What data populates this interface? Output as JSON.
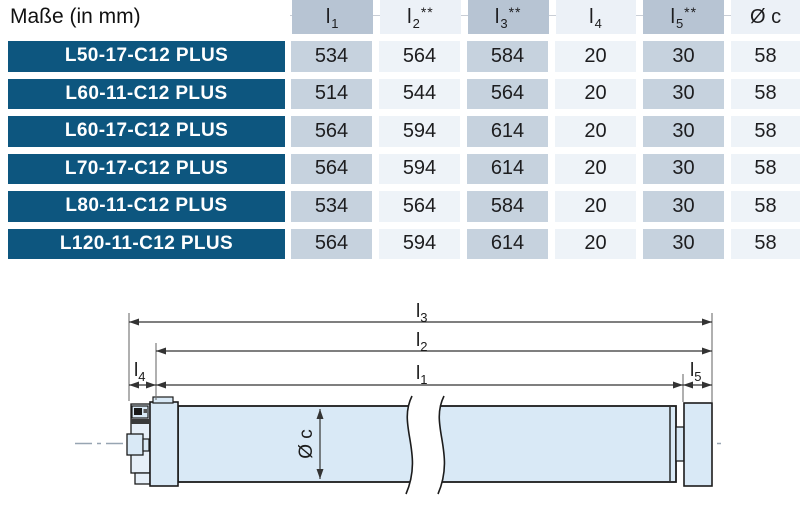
{
  "colors": {
    "model_badge_blue": "#0d567f",
    "header_col_dark": "#b7c4d3",
    "header_col_light": "#ecf1f7",
    "data_col_dark": "#c6d2de",
    "data_col_light": "#eef3f8",
    "tube_fill_blue": "#d9e9f6",
    "outline_dark": "#1c1c1c"
  },
  "table": {
    "title": "Maße (in mm)",
    "columns": [
      {
        "base": "l",
        "sub": "1",
        "sup": ""
      },
      {
        "base": "l",
        "sub": "2",
        "sup": "**"
      },
      {
        "base": "l",
        "sub": "3",
        "sup": "**"
      },
      {
        "base": "l",
        "sub": "4",
        "sup": ""
      },
      {
        "base": "l",
        "sub": "5",
        "sup": "**"
      },
      {
        "base": "Ø c",
        "sub": "",
        "sup": ""
      }
    ],
    "rows": [
      {
        "model": "L50-17-C12 PLUS",
        "values": [
          "534",
          "564",
          "584",
          "20",
          "30",
          "58"
        ]
      },
      {
        "model": "L60-11-C12 PLUS",
        "values": [
          "514",
          "544",
          "564",
          "20",
          "30",
          "58"
        ]
      },
      {
        "model": "L60-17-C12 PLUS",
        "values": [
          "564",
          "594",
          "614",
          "20",
          "30",
          "58"
        ]
      },
      {
        "model": "L70-17-C12 PLUS",
        "values": [
          "564",
          "594",
          "614",
          "20",
          "30",
          "58"
        ]
      },
      {
        "model": "L80-11-C12 PLUS",
        "values": [
          "534",
          "564",
          "584",
          "20",
          "30",
          "58"
        ]
      },
      {
        "model": "L120-11-C12 PLUS",
        "values": [
          "564",
          "594",
          "614",
          "20",
          "30",
          "58"
        ]
      }
    ]
  },
  "diagram": {
    "dims": {
      "l1": {
        "base": "l",
        "sub": "1"
      },
      "l2": {
        "base": "l",
        "sub": "2"
      },
      "l3": {
        "base": "l",
        "sub": "3"
      },
      "l4": {
        "base": "l",
        "sub": "4"
      },
      "l5": {
        "base": "l",
        "sub": "5"
      },
      "diameter": "Ø c"
    }
  }
}
